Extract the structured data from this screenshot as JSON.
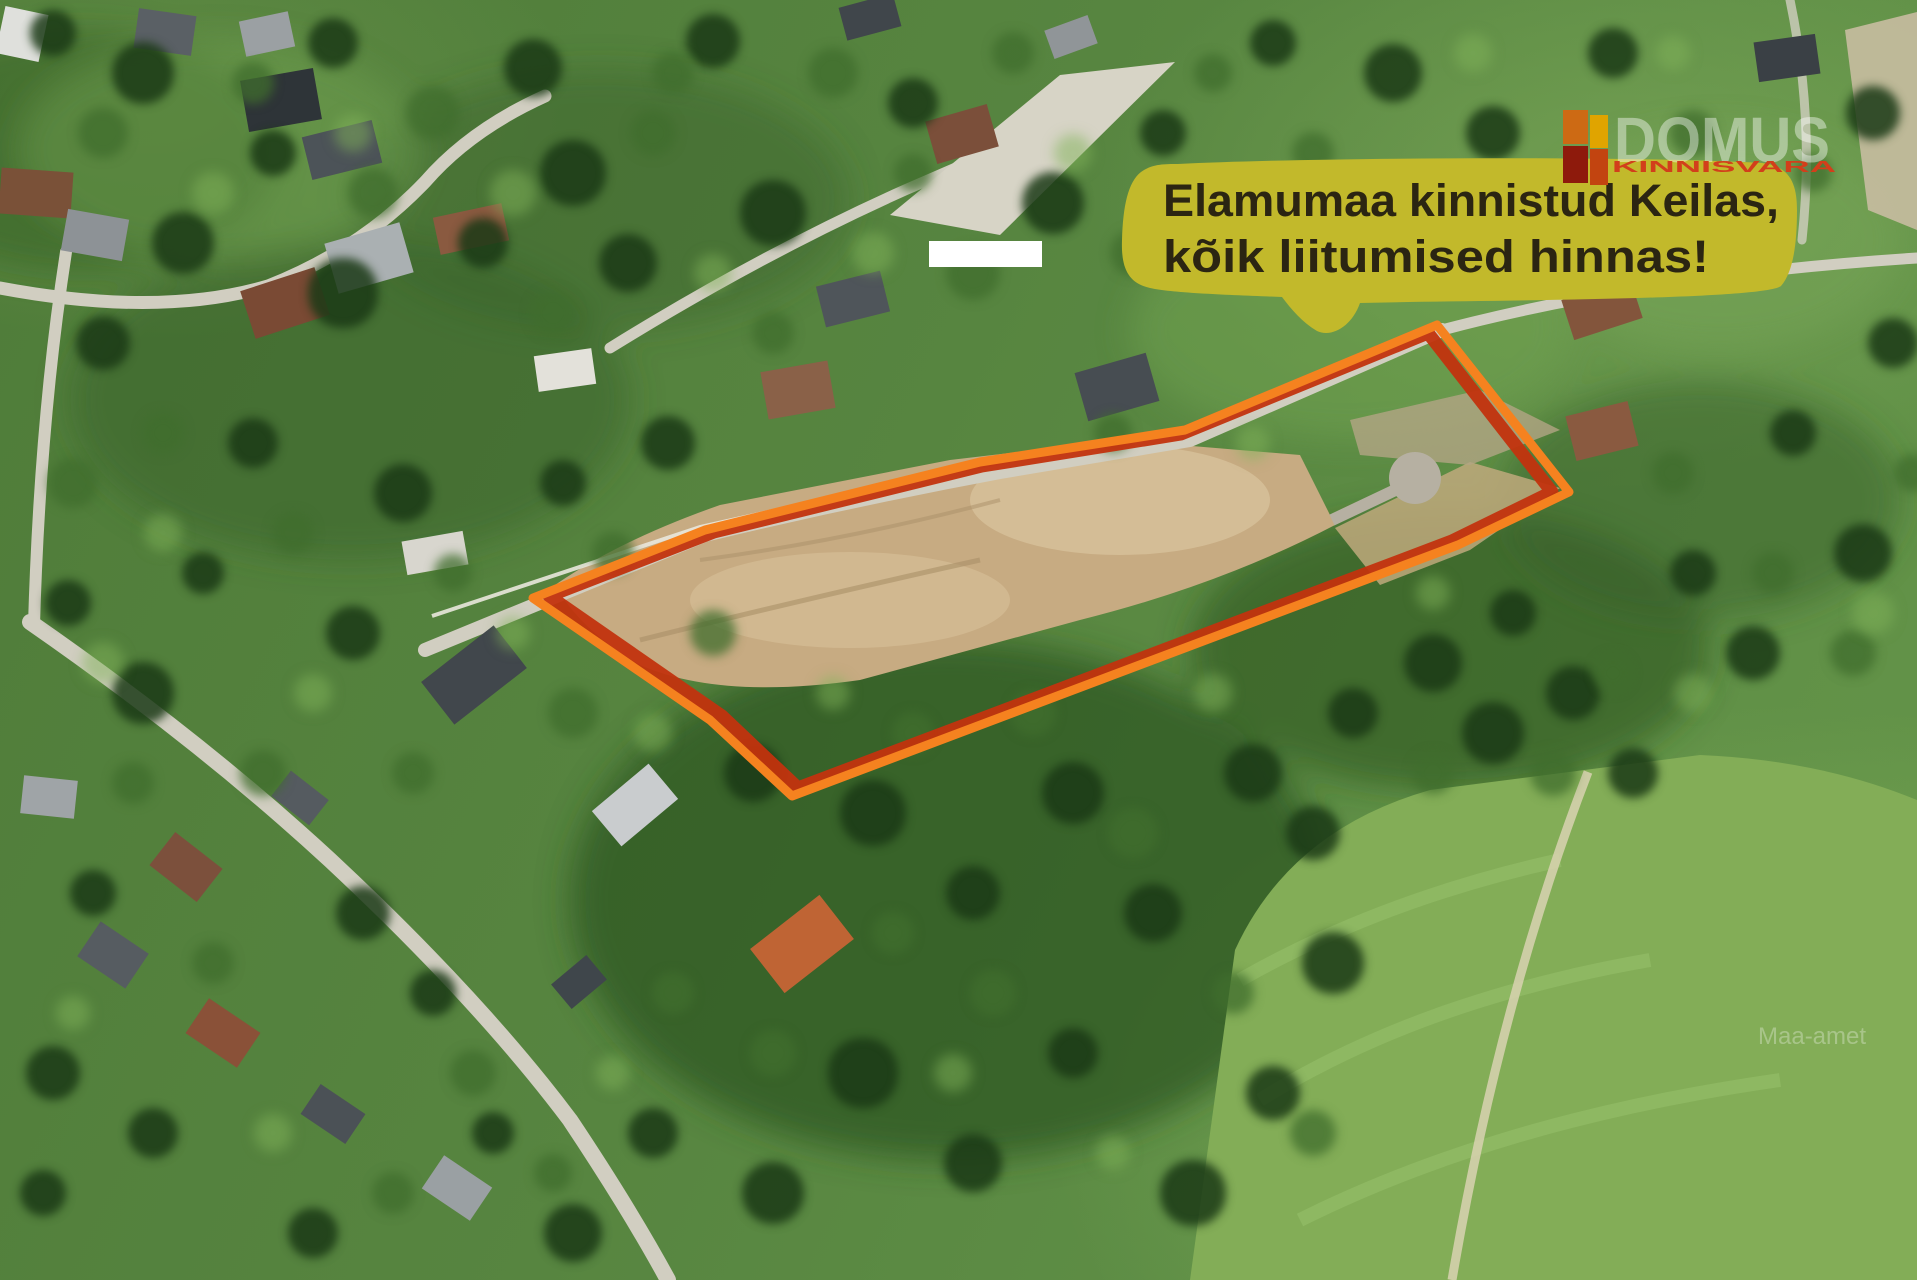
{
  "annotation": {
    "bubble": {
      "line1": "Elamumaa kinnistud Keilas,",
      "line2": "kõik liitumised hinnas!",
      "bg_color": "#c2b92b",
      "text_color": "#2b2512"
    },
    "boundary": {
      "outer_color": "#f5821f",
      "inner_color": "#c2330e"
    }
  },
  "logo": {
    "name": "DOMUS",
    "subtitle": "KINNISVARA",
    "subtitle_color": "#d23f1b",
    "block_colors": [
      "#cd6a14",
      "#8e1a0c",
      "#e0a400",
      "#c24410"
    ]
  },
  "watermark": {
    "text": "Maa-amet"
  }
}
